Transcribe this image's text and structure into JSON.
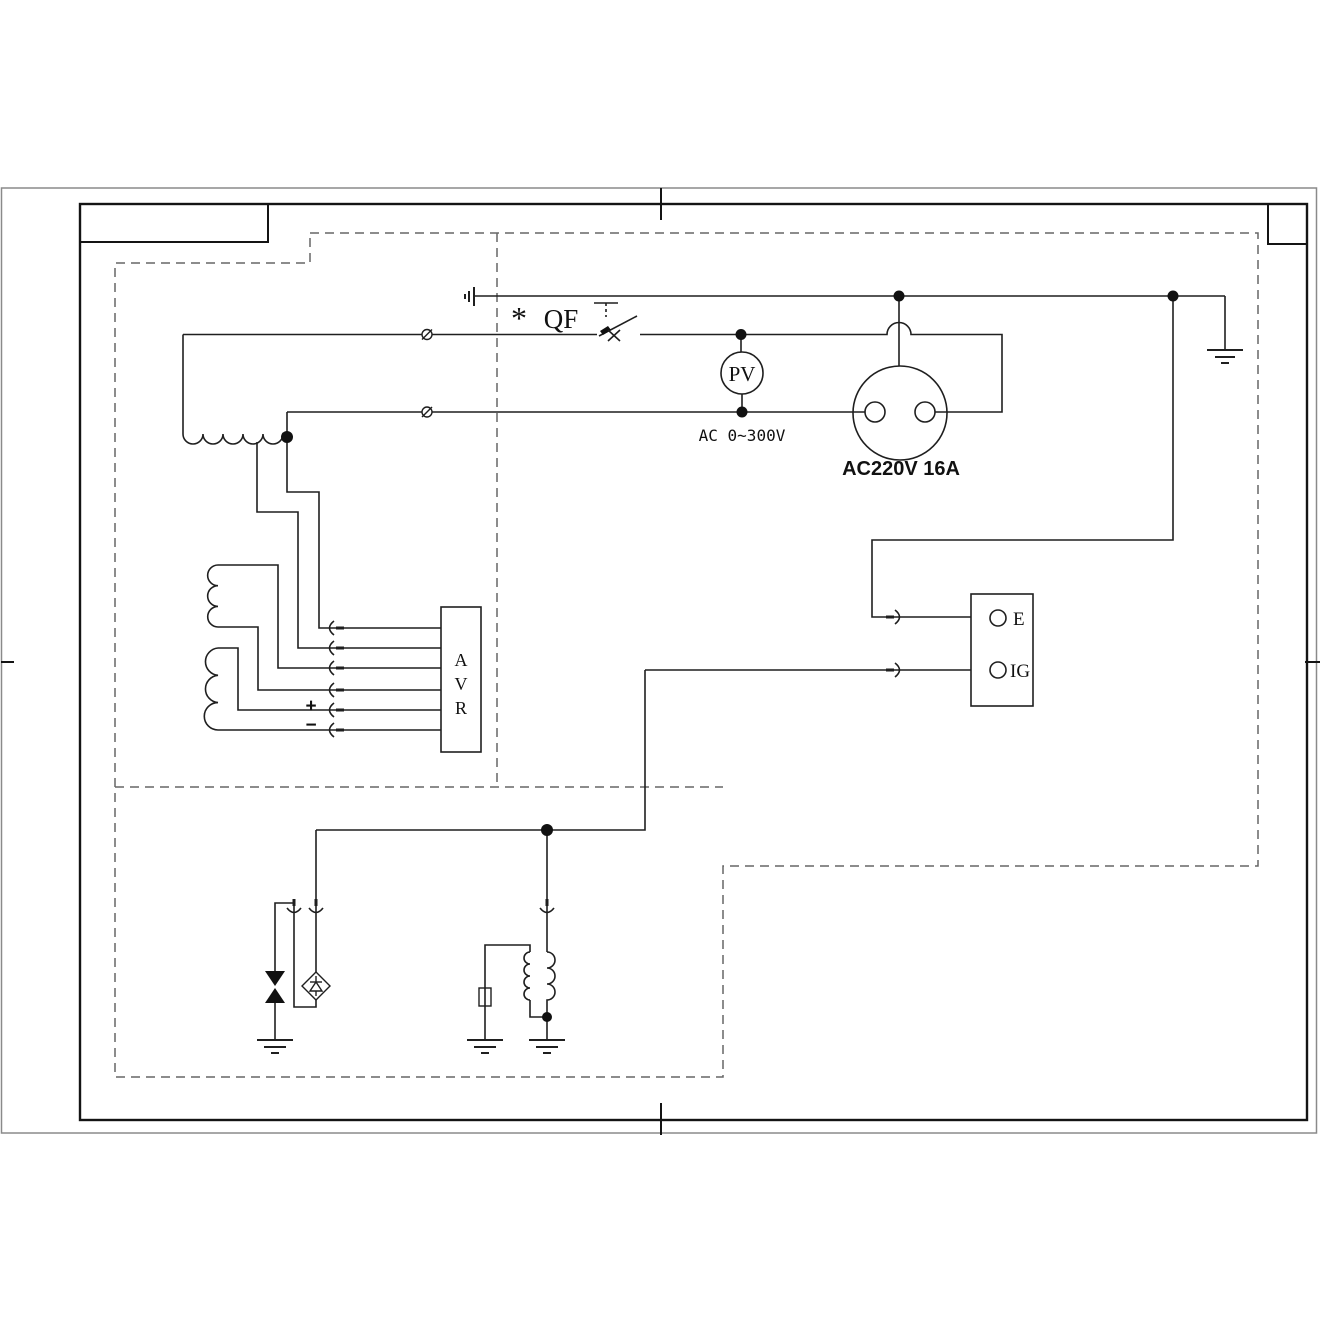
{
  "page": {
    "background": "#ffffff",
    "frame_color": "#141414",
    "dash_color": "#666666",
    "line_color": "#1f1f1f"
  },
  "labels": {
    "breaker_mark": "*",
    "breaker": "QF",
    "voltmeter": "PV",
    "voltmeter_range": "AC 0~300V",
    "socket_rating": "AC220V 16A",
    "avr_a": "A",
    "avr_v": "V",
    "avr_r": "R",
    "plus": "+",
    "minus": "−",
    "terminal_e": "E",
    "terminal_ig": "IG"
  }
}
